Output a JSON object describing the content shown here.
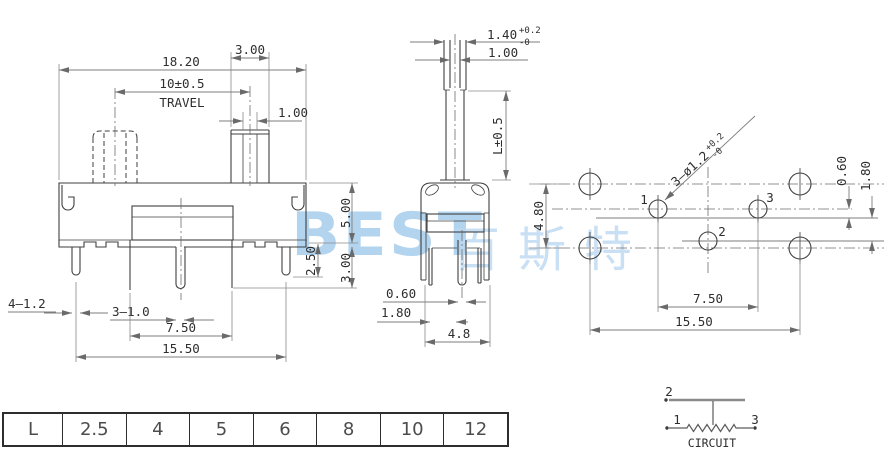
{
  "drawing": {
    "front_view": {
      "dim_body_width": "18.20",
      "dim_knob_width": "3.00",
      "dim_travel": "10±0.5",
      "travel_label": "TRAVEL",
      "dim_slot_width": "1.00",
      "dim_body_height": "5.00",
      "dim_pin_len_outer": "2.50",
      "dim_pin_len_inner": "3.00",
      "label_corner_pins": "4—1.2",
      "label_middle_pins": "3—1.0",
      "dim_middle_pin_span": "7.50",
      "dim_corner_pin_span": "15.50"
    },
    "side_view": {
      "dim_stem_width": "1.40",
      "stem_tol_upper": "+0.2",
      "stem_tol_lower": "-0",
      "dim_stem_slot": "1.00",
      "dim_stem_height": "L±0.5",
      "dim_pin_width": "0.60",
      "dim_pin_offset": "1.80",
      "dim_body_depth": "4.8"
    },
    "pcb_view": {
      "hole_callout": "3—ø1.2",
      "hole_tol_upper": "+0.2",
      "hole_tol_lower": "-0",
      "label_pin1": "1",
      "label_pin2": "2",
      "label_pin3": "3",
      "dim_mount_row_span": "4.80",
      "dim_offset_small": "0.60",
      "dim_offset_large": "1.80",
      "dim_pin_span": "7.50",
      "dim_mount_span": "15.50"
    }
  },
  "size_table": {
    "header": "L",
    "values": [
      "2.5",
      "4",
      "5",
      "6",
      "8",
      "10",
      "12"
    ]
  },
  "circuit": {
    "terminal_top": "2",
    "terminal_left": "1",
    "terminal_right": "3",
    "caption": "CIRCUIT"
  },
  "watermark": {
    "latin": "BEST",
    "cjk": "百斯特",
    "color": "#b3d4ef"
  }
}
